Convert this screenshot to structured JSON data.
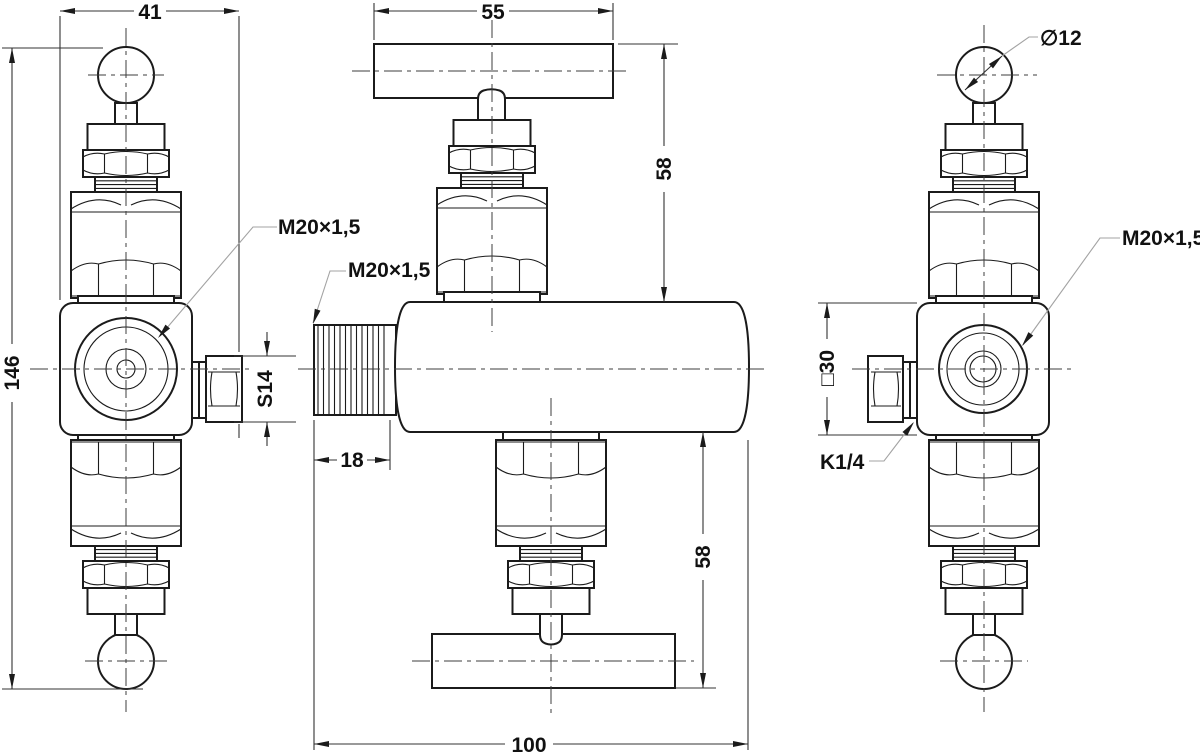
{
  "drawing": {
    "background": "#ffffff",
    "line_color": "#1b1b1b",
    "leader_color": "#a3a3a3",
    "labels": {
      "dim_width_41": "41",
      "dim_height_146": "146",
      "dim_hex_s14": "S14",
      "label_port_left_view": "M20×1,5",
      "dim_handle_55": "55",
      "dim_upper_58": "58",
      "dim_lower_58": "58",
      "label_inlet_thread": "M20×1,5",
      "dim_thread_len_18": "18",
      "dim_length_100": "100",
      "dim_handle_dia_12": "∅12",
      "label_gauge_thread": "M20×1,5",
      "dim_body_square_30": "□30",
      "label_test_port_k14": "K1/4"
    }
  }
}
